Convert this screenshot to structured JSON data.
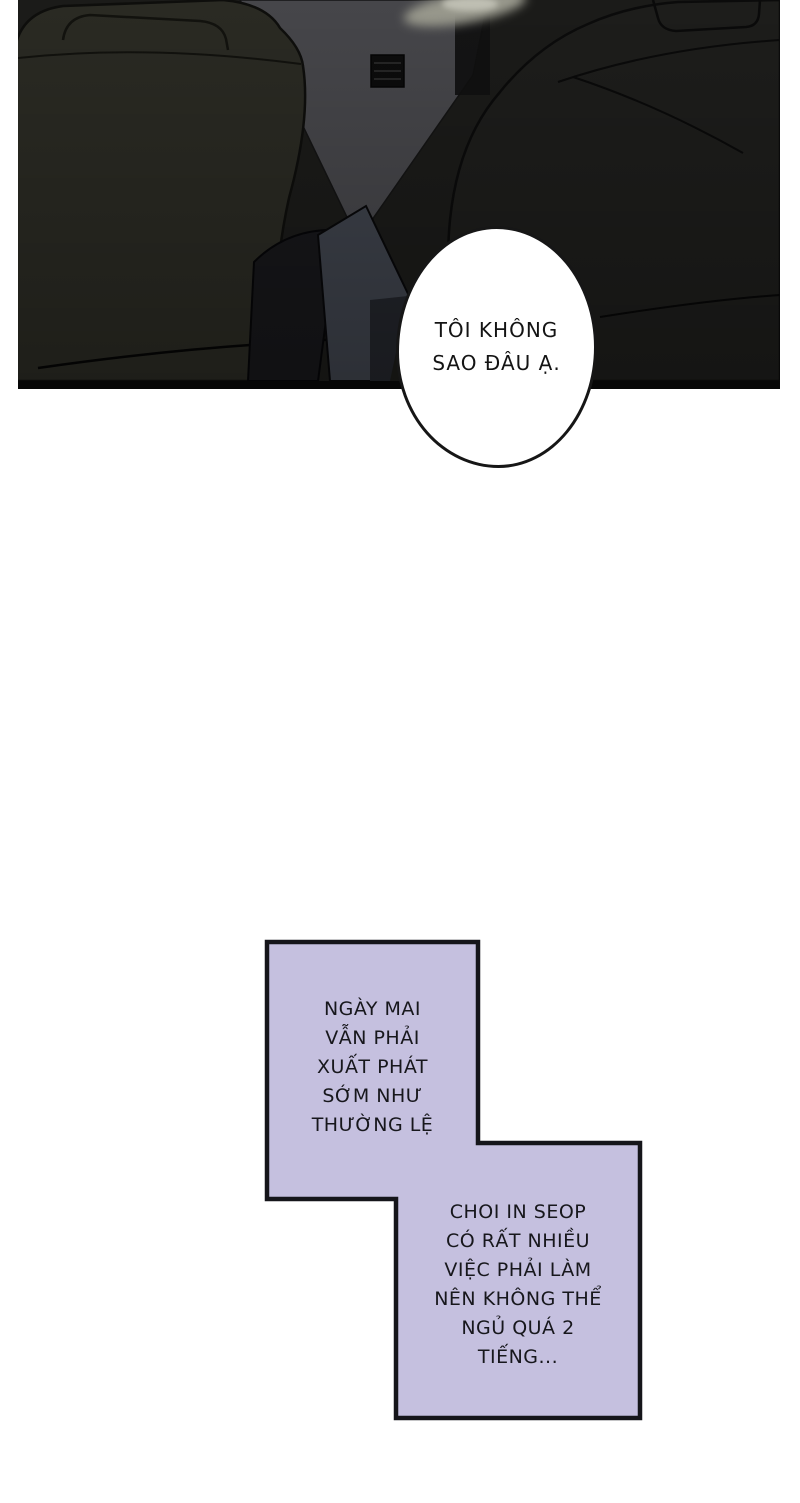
{
  "speech_bubble": {
    "lines": [
      "TÔI KHÔNG",
      "SAO ĐÂU Ạ."
    ]
  },
  "captions": {
    "box1": {
      "lines": [
        "NGÀY MAI",
        "VẪN PHẢI",
        "XUẤT PHÁT",
        "SỚM NHƯ",
        "THƯỜNG LỆ"
      ]
    },
    "box2": {
      "lines": [
        "CHOI IN SEOP",
        "CÓ RẤT NHIỀU",
        "VIỆC PHẢI LÀM",
        "NÊN KHÔNG THỂ",
        "NGỦ QUÁ 2",
        "TIẾNG..."
      ]
    }
  },
  "colors": {
    "page_background": "#ffffff",
    "panel_base": "#1b1b19",
    "left_seat": "#2a2a23",
    "right_seat": "#1d1d1b",
    "window_gray": "#46464a",
    "arm_gray": "#3e424b",
    "outline_ink": "#0a0a0a",
    "panel_bottom_border": "#060606",
    "bubble_fill": "#ffffff",
    "bubble_border": "#161616",
    "caption_fill": "#c5c0df",
    "caption_border": "#15151a",
    "text_ink": "#17171c"
  }
}
